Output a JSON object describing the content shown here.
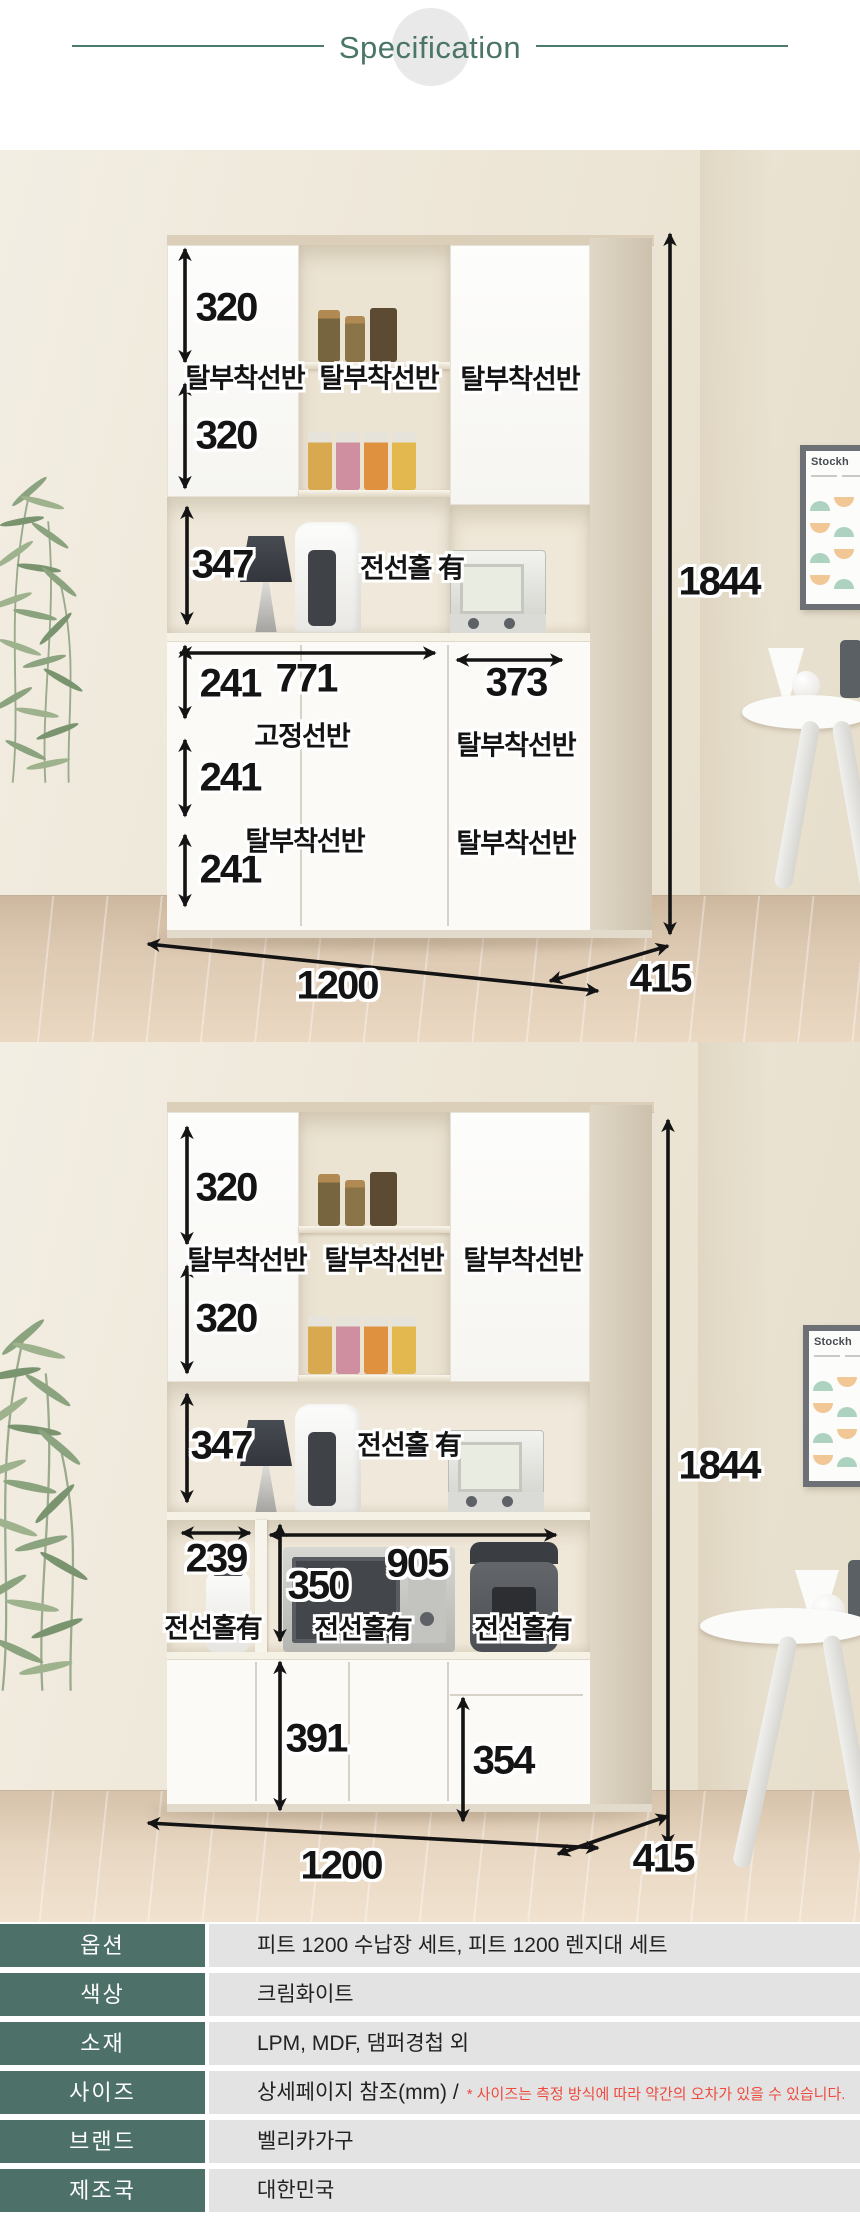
{
  "header": {
    "title": "Specification"
  },
  "photo1": {
    "dims": {
      "top_shelf_a": "320",
      "top_shelf_b": "320",
      "counter_height": "347",
      "cell_a": "241",
      "cell_b": "241",
      "cell_c": "241",
      "left_width": "771",
      "right_width": "373",
      "total_width": "1200",
      "depth": "415",
      "total_height": "1844"
    },
    "labels": {
      "shelf_top_left": "탈부착선반",
      "shelf_top_mid": "탈부착선반",
      "shelf_top_right": "탈부착선반",
      "wire_hole": "전선홀 有",
      "fixed_shelf": "고정선반",
      "shelf_bottom": "탈부착선반",
      "shelf_right_top": "탈부착선반",
      "shelf_right_bottom": "탈부착선반"
    },
    "poster_title": "Stockh"
  },
  "photo2": {
    "dims": {
      "top_shelf_a": "320",
      "top_shelf_b": "320",
      "counter_height": "347",
      "left_bay_width": "239",
      "right_bay_width": "905",
      "bay_height": "350",
      "door_height": "391",
      "drawer_height": "354",
      "total_width": "1200",
      "depth": "415",
      "total_height": "1844"
    },
    "labels": {
      "shelf_top_left": "탈부착선반",
      "shelf_top_mid": "탈부착선반",
      "shelf_top_right": "탈부착선반",
      "wire_hole_top": "전선홀 有",
      "wire_hole_left": "전선홀有",
      "wire_hole_mid": "전선홀有",
      "wire_hole_right": "전선홀有"
    },
    "poster_title": "Stockh"
  },
  "spec_table": {
    "rows": [
      {
        "label": "옵션",
        "value": "피트 1200 수납장 세트, 피트 1200 렌지대 세트"
      },
      {
        "label": "색상",
        "value": "크림화이트"
      },
      {
        "label": "소재",
        "value": "LPM, MDF, 댐퍼경첩 외"
      },
      {
        "label": "사이즈",
        "value": "상세페이지 참조(mm) /",
        "note": "* 사이즈는 측정 방식에 따라 약간의 오차가 있을 수 있습니다."
      },
      {
        "label": "브랜드",
        "value": "벨리카가구"
      },
      {
        "label": "제조국",
        "value": "대한민국"
      }
    ]
  },
  "colors": {
    "accent_green": "#4d7069",
    "header_line": "#4e7b6f",
    "table_value_bg": "#e3e3e3",
    "note_red": "#ee4b3e"
  }
}
